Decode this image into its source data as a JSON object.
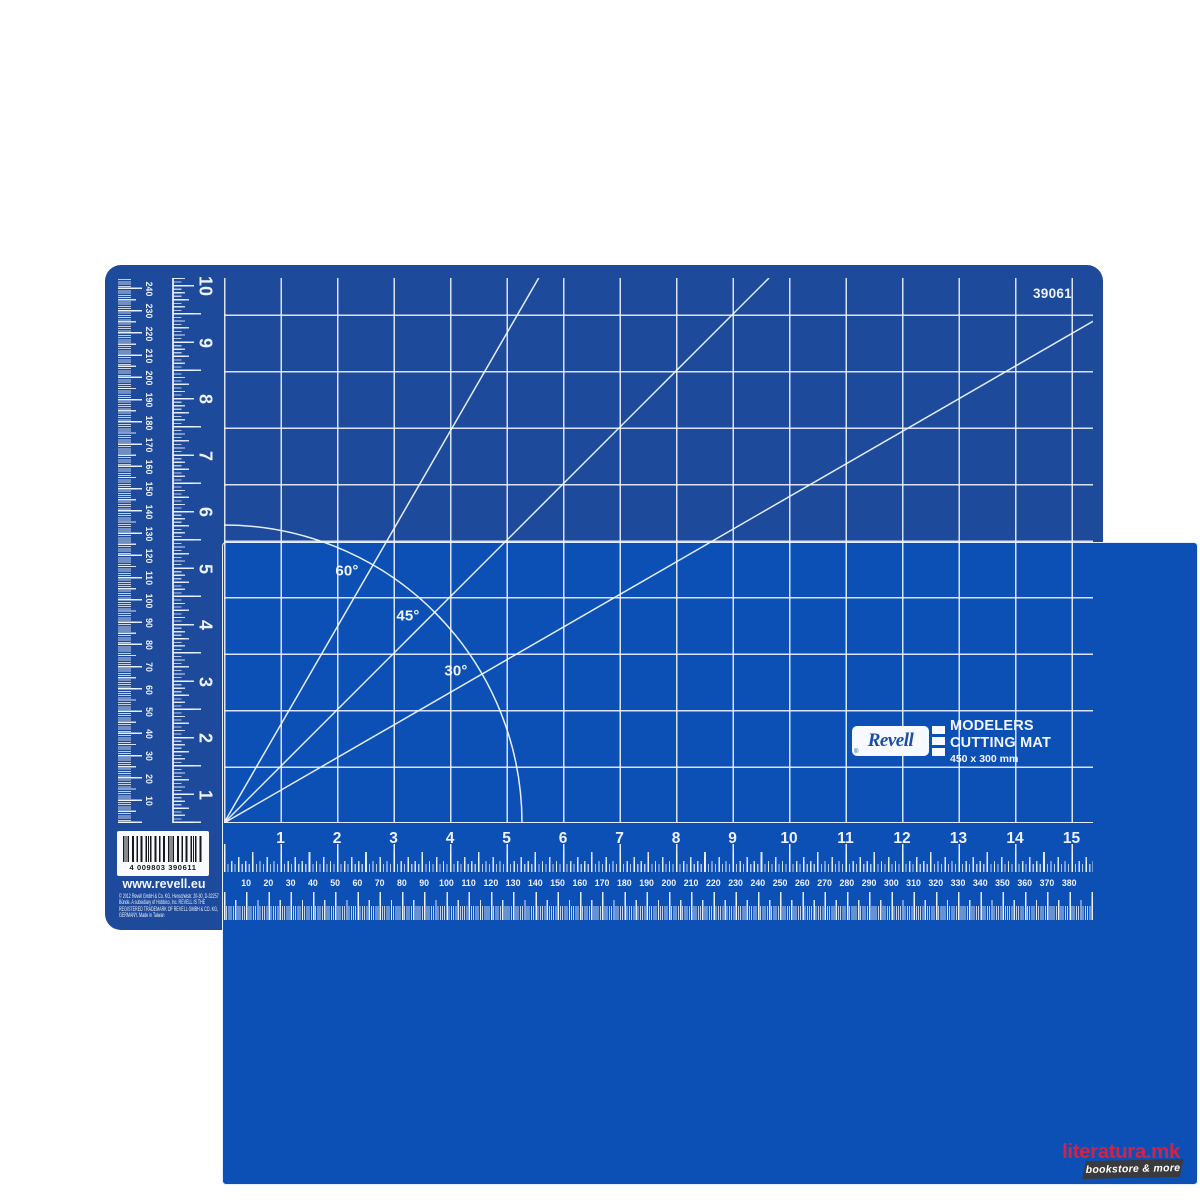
{
  "mat": {
    "product_code": "39061",
    "colors": {
      "border": "#1e4a9b",
      "surface": "#0c50b5",
      "markings": "#edf2fd"
    },
    "angle_labels": {
      "deg60": "60°",
      "deg45": "45°",
      "deg30": "30°"
    },
    "logo": {
      "brand": "Revell",
      "registered": "®",
      "title_line1": "MODELERS",
      "title_line2": "CUTTING MAT",
      "size_line": "450 x 300 mm"
    },
    "footer": {
      "barcode_digits": "4 009803 390611",
      "website": "www.revell.eu",
      "legal_lines": [
        "© 2012 Revell GmbH & Co. KG, Henschelstr. 20-30, D-32257",
        "Bünde. A subsidiary of Hobbico, Inc. REVELL IS THE",
        "REGISTERED TRADEMARK OF REVELL GMBH & CO. KG,",
        "GERMANY. Made in Taiwan"
      ]
    },
    "rulers": {
      "left_mm": {
        "labels": [
          "10",
          "20",
          "30",
          "40",
          "50",
          "60",
          "70",
          "80",
          "90",
          "100",
          "110",
          "120",
          "130",
          "140",
          "150",
          "160",
          "170",
          "180",
          "190",
          "200",
          "210",
          "220",
          "230",
          "240"
        ]
      },
      "left_inch": {
        "labels": [
          "1",
          "2",
          "3",
          "4",
          "5",
          "6",
          "7",
          "8",
          "9",
          "10"
        ]
      },
      "bottom_inch": {
        "labels": [
          "1",
          "2",
          "3",
          "4",
          "5",
          "6",
          "7",
          "8",
          "9",
          "10",
          "11",
          "12",
          "13",
          "14",
          "15"
        ]
      },
      "bottom_mm": {
        "labels": [
          "10",
          "20",
          "30",
          "40",
          "50",
          "60",
          "70",
          "80",
          "90",
          "100",
          "110",
          "120",
          "130",
          "140",
          "150",
          "160",
          "170",
          "180",
          "190",
          "200",
          "210",
          "220",
          "230",
          "240",
          "250",
          "260",
          "270",
          "280",
          "290",
          "300",
          "310",
          "320",
          "330",
          "340",
          "350",
          "360",
          "370",
          "380"
        ]
      }
    }
  },
  "watermark": {
    "site": "literatura.mk",
    "tagline": "bookstore & more",
    "accent_color": "#ce2449",
    "badge_color": "#3b3a3c"
  }
}
